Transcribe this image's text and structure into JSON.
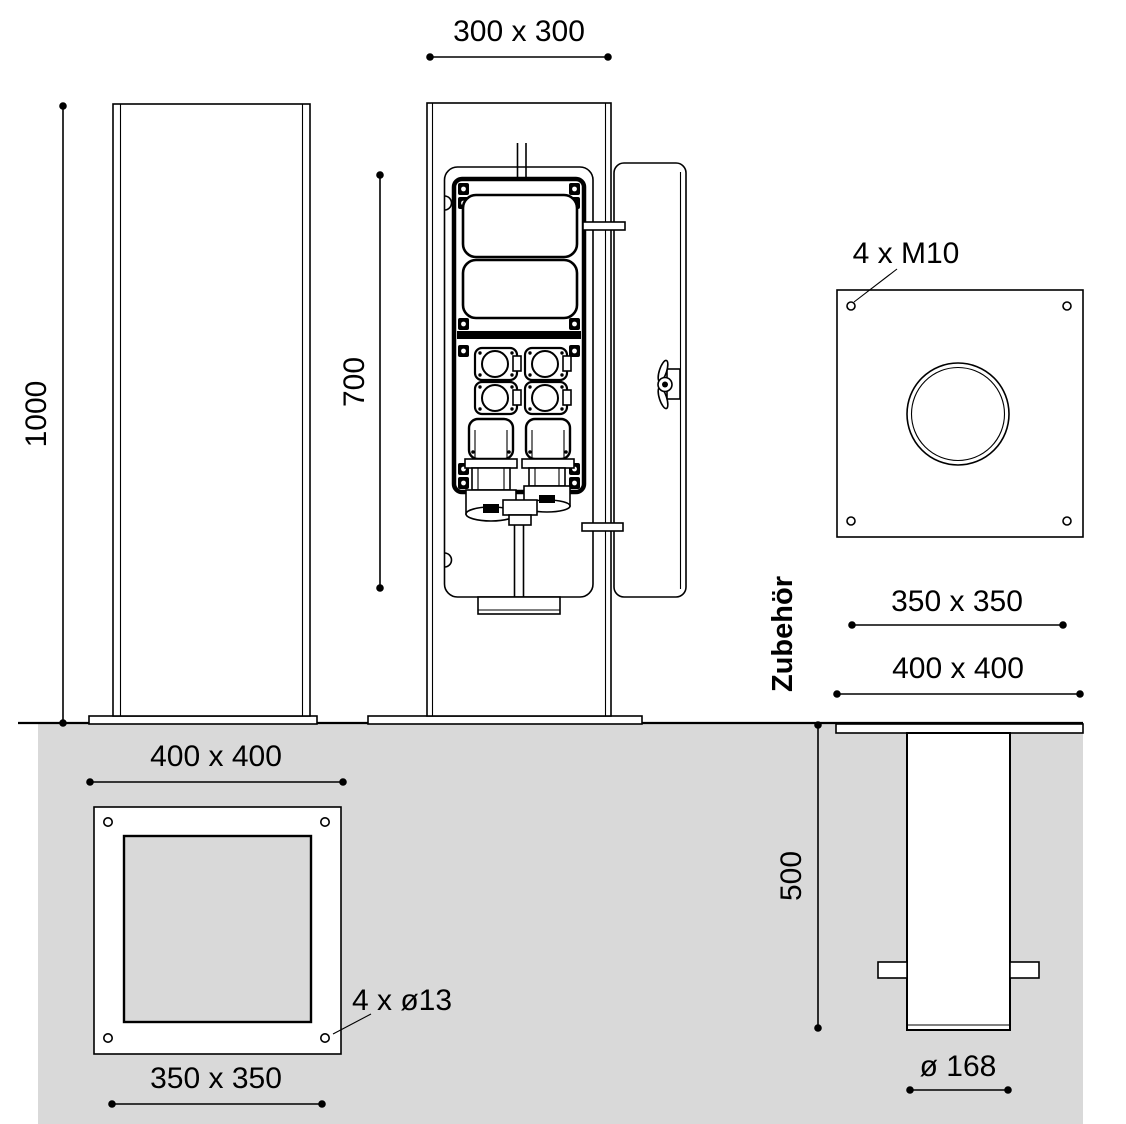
{
  "drawing": {
    "ground_color": "#d9d9d9",
    "labels": {
      "front_width": "300 x 300",
      "total_height": "1000",
      "panel_height": "700",
      "flange_bolts": "4 x M10",
      "accessories": "Zubehör",
      "flange_size": "350 x 350",
      "anchor_plate_size": "400 x 400",
      "base_plate_size": "400 x 400",
      "hole_spacing": "350 x 350",
      "base_holes": "4 x ø13",
      "embed_depth": "500",
      "tube_diameter": "ø 168"
    }
  }
}
